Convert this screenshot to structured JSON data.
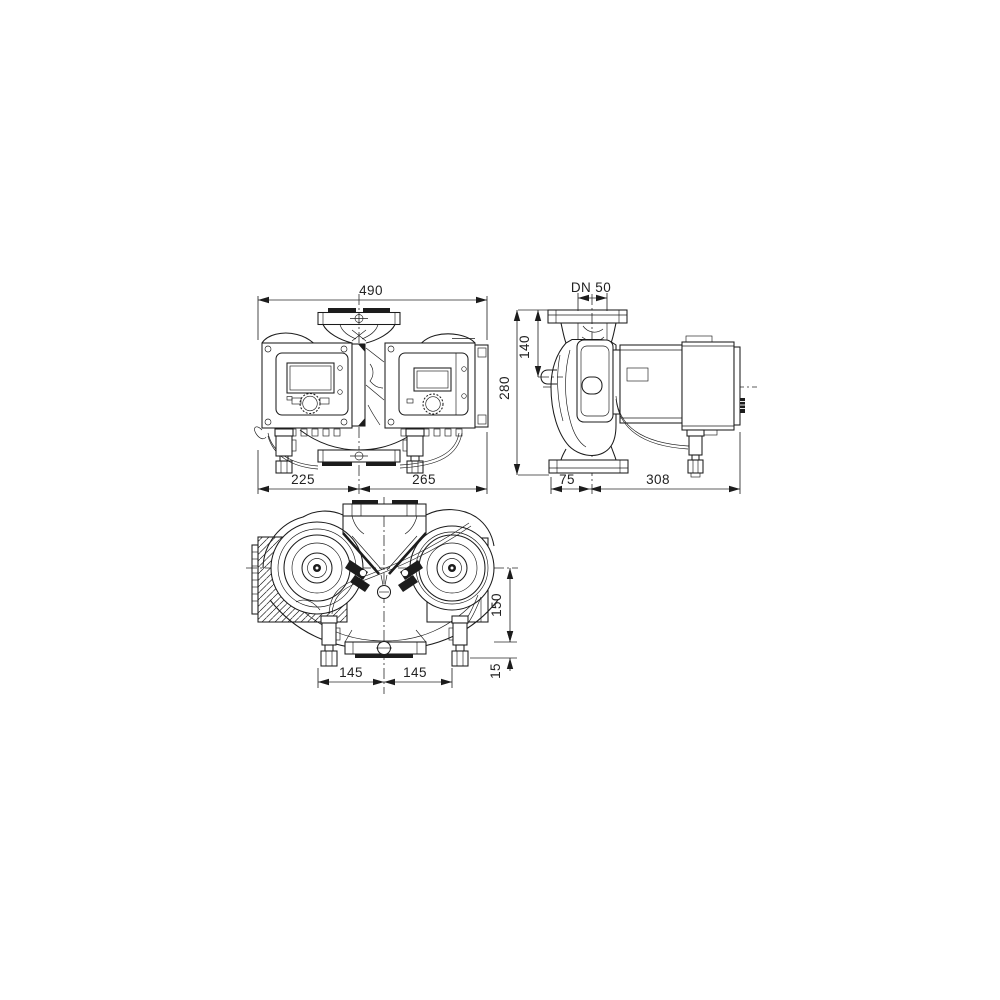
{
  "drawing": {
    "description": "Dimensional drawing of a glanded double inline circulation pump, three orthographic views",
    "front_view": {
      "dim_total_width": "490",
      "dim_left": "225",
      "dim_right": "265"
    },
    "side_view": {
      "dim_nominal_diameter": "DN 50",
      "dim_flange_to_axis": "140",
      "dim_total_height": "280",
      "dim_front_depth": "75",
      "dim_back_depth": "308"
    },
    "top_view": {
      "dim_axis_offset": "150",
      "dim_foot_offset": "15",
      "dim_pitch_left": "145",
      "dim_pitch_right": "145"
    }
  }
}
